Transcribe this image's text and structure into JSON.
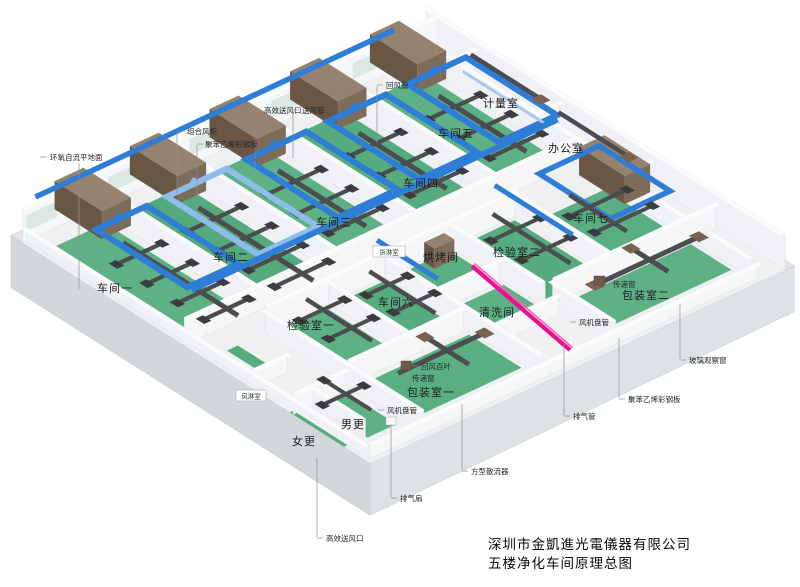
{
  "diagram": {
    "company_title": "深圳市金凱進光電儀器有限公司",
    "drawing_title": "五楼净化车间原理总图"
  },
  "rooms": {
    "workshop1": "车间一",
    "workshop2": "车间二",
    "workshop3": "车间三",
    "workshop4": "车间四",
    "workshop5": "车间五",
    "workshop6": "车间六",
    "workshop7": "车间七",
    "inspection1": "检验室一",
    "inspection2": "检验室二",
    "baking": "烘烤间",
    "cleaning": "清洗间",
    "packing1": "包装室一",
    "packing2": "包装室二",
    "office": "办公室",
    "metrology": "计量室",
    "mens_changing": "男更",
    "womens_changing": "女更",
    "air_shower": "风淋室",
    "cargo_shower": "货淋室"
  },
  "annotations": {
    "return_air_duct": "回风管",
    "hepa_supply_outlet": "高效送风口",
    "supply_air_duct": "送风管",
    "combined_ahu": "组合风柜",
    "polystyrene_panel": "聚苯乙烯彩钢板",
    "epoxy_floor": "环氧自流平地面",
    "return_air_louver": "回风百叶",
    "pass_through_window": "传递窗",
    "fan_coil_unit": "风机盘管",
    "exhaust_fan": "排气扇",
    "square_diffuser": "方型散流器",
    "exhaust_pipe": "排气管",
    "glass_observation_window": "玻璃观察窗"
  },
  "colors": {
    "floor_green": "#57ab7f",
    "supply_duct_blue": "#2e7ed8",
    "light_duct_blue": "#8fbde9",
    "dark_duct_gray": "#4b4d4f",
    "ahu_brown": "#8a7464",
    "exhaust_pink": "#ec1490",
    "slab_gray": "#d5d8db",
    "wall_white": "#f2f3f5"
  }
}
